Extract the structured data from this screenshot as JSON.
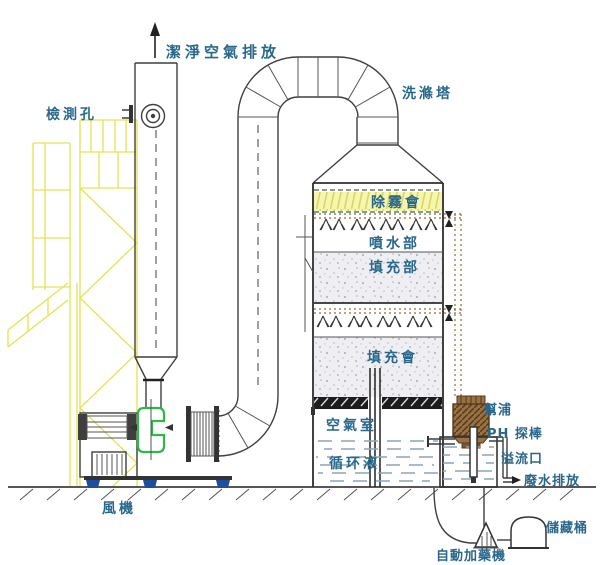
{
  "diagram": {
    "type": "scrubber-tower-process-diagram",
    "labels": {
      "clean_air": "潔淨空氣排放",
      "inspection_port": "檢測孔",
      "scrubber_tower": "洗滌塔",
      "demister": "除霧會",
      "spray_section": "噴水部",
      "packing_section": "填充部",
      "packing_layer": "填充會",
      "air_chamber": "空氣室",
      "circulating_liquid": "循环液",
      "pump": "幫浦",
      "ph_probe": "PH 探棒",
      "overflow": "溢流口",
      "wastewater": "廢水排放",
      "fan": "風機",
      "storage_barrel": "儲藏桶",
      "auto_doser": "自動加藥機"
    },
    "colors": {
      "label_text": "#29688c",
      "line": "#3f3f3f",
      "scaffold_yellow": "#e3e352",
      "demister_fill": "#f6f6ae",
      "packing_fill": "#eeeef3",
      "fan_green": "#2db84b",
      "mount_blue": "#1d4e9e",
      "pipe_brown": "#8a6d3b",
      "water_dash": "#8ea4b8",
      "pump_brown": "#9a7142"
    }
  }
}
